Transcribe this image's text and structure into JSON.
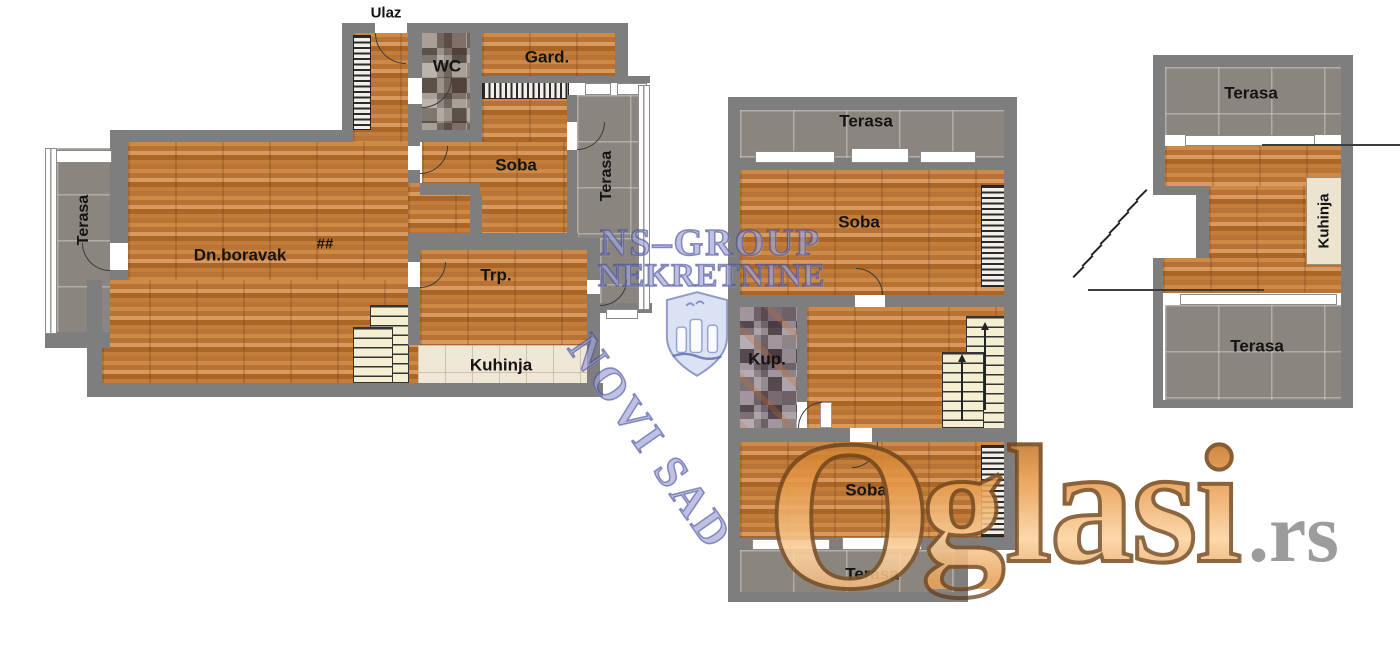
{
  "canvas": {
    "width": 1400,
    "height": 649
  },
  "colors": {
    "wall": "#7e7e7e",
    "wood_floor": "#c08040",
    "terrace_tile": "#8b8580",
    "kitchen_tile": "#eee7d6",
    "stair_fill": "#f4eed2",
    "label_text": "#141414",
    "watermark_blue": "#7a80c3",
    "watermark_orange": "#e8923c",
    "watermark_gray": "#8f8f8f"
  },
  "plans": {
    "left": {
      "rooms": {
        "entrance": "Ulaz",
        "wc": "WC",
        "wardrobe_room": "Gard.",
        "bedroom": "Soba",
        "terrace_left": "Terasa",
        "terrace_right": "Terasa",
        "living_room": "Dn.boravak",
        "floor_mark": "##",
        "dining": "Trp.",
        "kitchen": "Kuhinja"
      }
    },
    "middle": {
      "rooms": {
        "terrace_top": "Terasa",
        "bedroom_top": "Soba",
        "bathroom": "Kup.",
        "bedroom_bottom": "Soba",
        "terrace_bottom": "Terasa"
      }
    },
    "right": {
      "rooms": {
        "terrace_top": "Terasa",
        "kitchen": "Kuhinja",
        "terrace_bottom": "Terasa"
      }
    }
  },
  "watermarks": {
    "agency": {
      "line1": "NS–GROUP",
      "line2": "NEKRETNINE",
      "city": "NOVI SAD"
    },
    "site": {
      "initial": "O",
      "second": "g",
      "rest": "lasi",
      "suffix": ".rs"
    }
  }
}
